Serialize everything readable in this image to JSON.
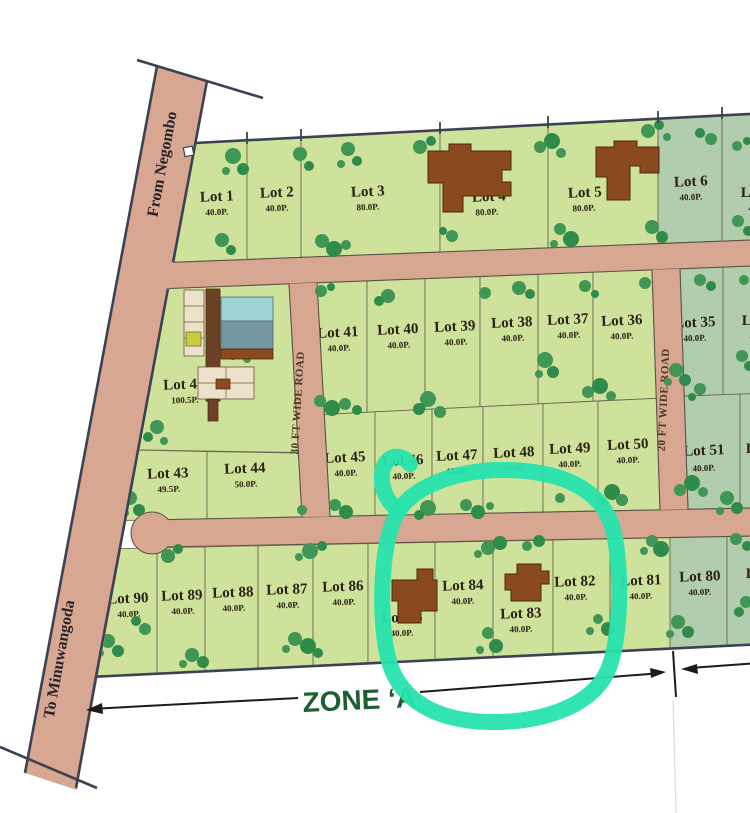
{
  "roads": {
    "from_negombo": "From Negombo",
    "to_minuwangoda": "To Minuwangoda",
    "road_30": "30 FT WIDE ROAD",
    "road_20": "20 FT WIDE ROAD"
  },
  "zone": {
    "label": "ZONE ‘A"
  },
  "lots": {
    "l1": {
      "name": "Lot 1",
      "size": "40.0P."
    },
    "l2": {
      "name": "Lot 2",
      "size": "40.0P."
    },
    "l3": {
      "name": "Lot 3",
      "size": "80.0P."
    },
    "l4": {
      "name": "Lot 4",
      "size": "80.0P."
    },
    "l5": {
      "name": "Lot 5",
      "size": "80.0P."
    },
    "l6": {
      "name": "Lot 6",
      "size": "40.0P."
    },
    "l7edge": {
      "name": "Lot",
      "size": "40"
    },
    "l41": {
      "name": "Lot 41",
      "size": "40.0P."
    },
    "l40": {
      "name": "Lot 40",
      "size": "40.0P."
    },
    "l39": {
      "name": "Lot 39",
      "size": "40.0P."
    },
    "l38": {
      "name": "Lot 38",
      "size": "40.0P."
    },
    "l37": {
      "name": "Lot 37",
      "size": "40.0P."
    },
    "l36": {
      "name": "Lot 36",
      "size": "40.0P."
    },
    "l35": {
      "name": "Lot 35",
      "size": "40.0P."
    },
    "l34edge": {
      "name": "Lot",
      "size": "40"
    },
    "l42": {
      "name": "Lot 42",
      "size": "100.5P."
    },
    "l43": {
      "name": "Lot 43",
      "size": "49.5P."
    },
    "l44": {
      "name": "Lot 44",
      "size": "50.0P."
    },
    "l45": {
      "name": "Lot 45",
      "size": "40.0P."
    },
    "l46": {
      "name": "Lot 46",
      "size": "40.0P."
    },
    "l47": {
      "name": "Lot 47",
      "size": "40.0P."
    },
    "l48": {
      "name": "Lot 48",
      "size": "40.0P."
    },
    "l49": {
      "name": "Lot 49",
      "size": "40.0P."
    },
    "l50": {
      "name": "Lot 50",
      "size": "40.0P."
    },
    "l51": {
      "name": "Lot 51",
      "size": "40.0P."
    },
    "l52edge": {
      "name": "Lot"
    },
    "l90": {
      "name": "Lot 90",
      "size": "40.0P."
    },
    "l89": {
      "name": "Lot 89",
      "size": "40.0P."
    },
    "l88": {
      "name": "Lot 88",
      "size": "40.0P."
    },
    "l87": {
      "name": "Lot 87",
      "size": "40.0P."
    },
    "l86": {
      "name": "Lot 86",
      "size": "40.0P."
    },
    "l85": {
      "name": "Lot 85",
      "size": "40.0P."
    },
    "l84": {
      "name": "Lot 84",
      "size": "40.0P."
    },
    "l83": {
      "name": "Lot 83",
      "size": "40.0P."
    },
    "l82": {
      "name": "Lot 82",
      "size": "40.0P."
    },
    "l81": {
      "name": "Lot 81",
      "size": "40.0P."
    },
    "l80": {
      "name": "Lot 80",
      "size": "40.0P."
    },
    "l79edge": {
      "name": "Lot"
    }
  },
  "colors": {
    "lot_available": "#cfe29b",
    "lot_reserved": "#b2cdad",
    "road": "#d7a791",
    "tree": "#3f9655",
    "building": "#8a4a1e",
    "pool_light": "#9ed3d6",
    "pool_dark": "#7796a4",
    "annotation_circle": "#27e3ae",
    "zone_text": "#1d5f31"
  }
}
